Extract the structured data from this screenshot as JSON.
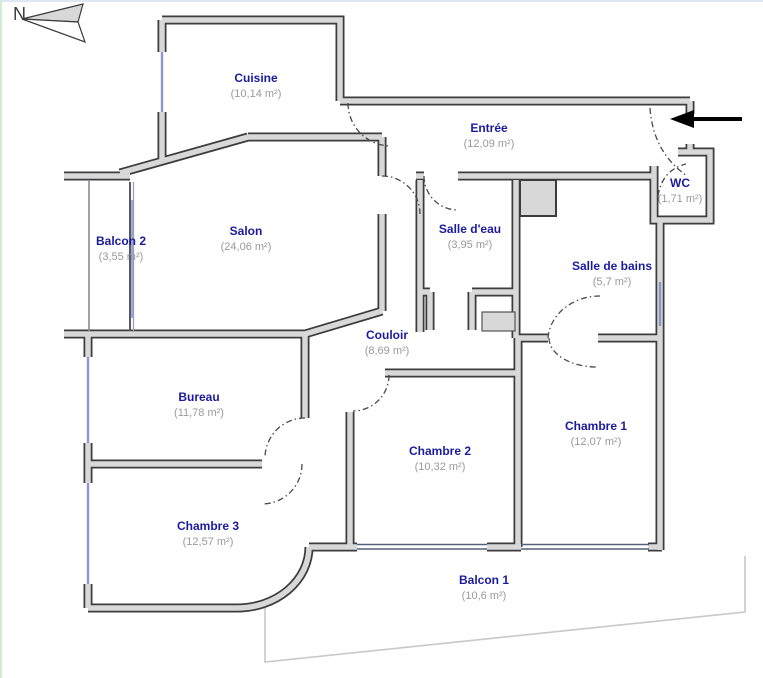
{
  "meta": {
    "compass_label": "N"
  },
  "rooms": [
    {
      "name": "Cuisine",
      "area": "(10,14 m²)"
    },
    {
      "name": "Entrée",
      "area": "(12,09 m²)"
    },
    {
      "name": "WC",
      "area": "(1,71 m²)"
    },
    {
      "name": "Balcon 2",
      "area": "(3,55 m²)"
    },
    {
      "name": "Salon",
      "area": "(24,06 m²)"
    },
    {
      "name": "Salle d'eau",
      "area": "(3,95 m²)"
    },
    {
      "name": "Salle de bains",
      "area": "(5,7 m²)"
    },
    {
      "name": "Couloir",
      "area": "(8,69 m²)"
    },
    {
      "name": "Bureau",
      "area": "(11,78 m²)"
    },
    {
      "name": "Chambre 1",
      "area": "(12,07 m²)"
    },
    {
      "name": "Chambre 2",
      "area": "(10,32 m²)"
    },
    {
      "name": "Chambre 3",
      "area": "(12,57 m²)"
    },
    {
      "name": "Balcon 1",
      "area": "(10,6 m²)"
    }
  ],
  "colors": {
    "room_name": "#1b1b9e",
    "room_area": "#9a9a9a",
    "wall_fill": "#d8d8d8",
    "wall_outline": "#3c3c3c",
    "window": "#8a97cc",
    "entrance_arrow": "#000000",
    "balcony_outline": "#c8c8c8"
  }
}
